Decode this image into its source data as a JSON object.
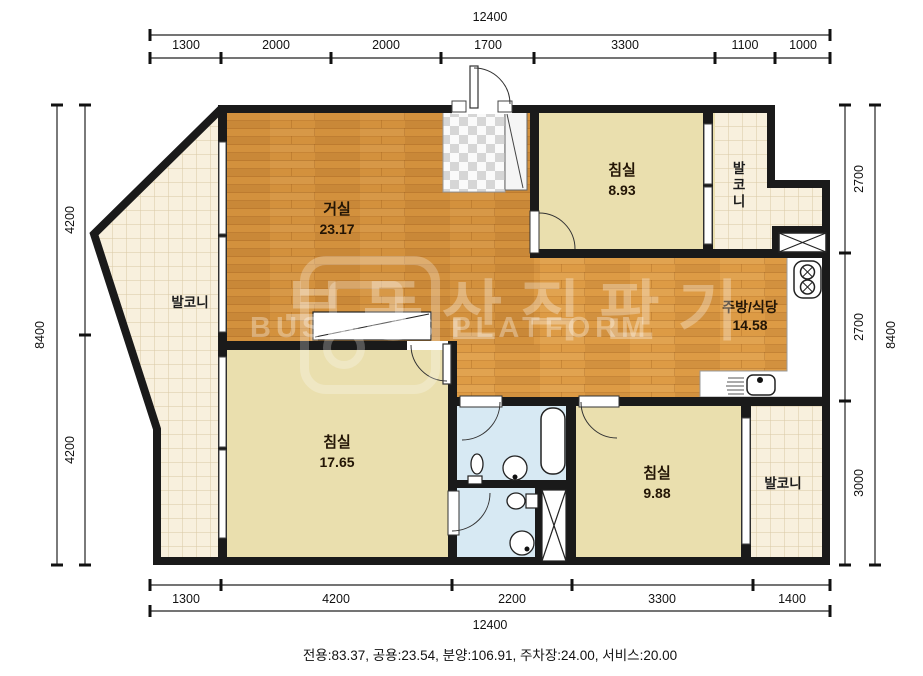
{
  "rooms": {
    "living": {
      "name": "거실",
      "area": "23.17"
    },
    "bedroom_top": {
      "name": "침실",
      "area": "8.93"
    },
    "bedroom_left": {
      "name": "침실",
      "area": "17.65"
    },
    "bedroom_right": {
      "name": "침실",
      "area": "9.88"
    },
    "kitchen": {
      "name": "주방/식당",
      "area": "14.58"
    },
    "balcony_left": {
      "name": "발코니"
    },
    "balcony_top_right": {
      "name": "발코니"
    },
    "balcony_bottom_right": {
      "name": "발코니"
    }
  },
  "dimensions": {
    "top": {
      "total": "12400",
      "segments": [
        "1300",
        "2000",
        "2000",
        "1700",
        "3300",
        "1100",
        "1000"
      ]
    },
    "bottom": {
      "total": "12400",
      "segments": [
        "1300",
        "4200",
        "2200",
        "3300",
        "1400"
      ]
    },
    "left": {
      "total": "8400",
      "segments": [
        "4200",
        "4200"
      ]
    },
    "right": {
      "total": "8400",
      "segments": [
        "2700",
        "2700",
        "3000"
      ]
    }
  },
  "footer": {
    "summary": "전용:83.37, 공용:23.54, 분양:106.91, 주차장:24.00, 서비스:20.00"
  },
  "watermark": {
    "korean": "부동산직판기",
    "english": "BUSINESS PLATFORM"
  },
  "colors": {
    "wall": "#1a1a1a",
    "wood_floor": "#dd9b45",
    "bedroom_floor": "#eadfae",
    "balcony_tile": "#f8f0dd",
    "bathroom": "#d7e9f3",
    "entrance_checker": "#d9d9d9",
    "dimension_text": "#111111"
  }
}
